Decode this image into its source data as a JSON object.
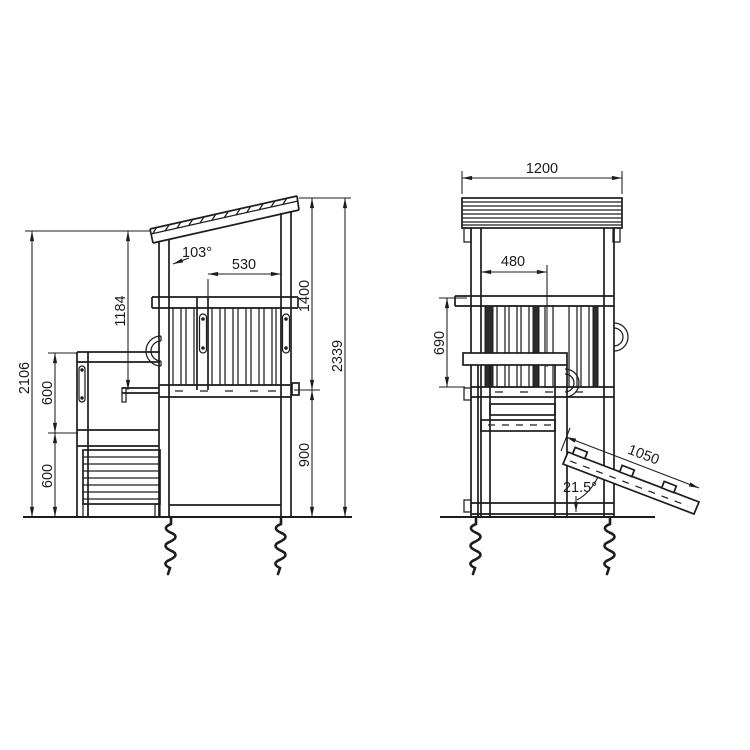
{
  "drawing": {
    "background": "#ffffff",
    "line_color": "#1d1d1d",
    "side_view": {
      "labels": {
        "overall_height_left": "2106",
        "annex_upper_height": "600",
        "annex_lower_height": "600",
        "roof_to_deck": "1184",
        "roof_angle": "103°",
        "deck_opening_width": "530",
        "roof_to_deck_right": "1400",
        "overall_height": "2339",
        "deck_height": "900"
      }
    },
    "front_view": {
      "labels": {
        "roof_width": "1200",
        "entry_offset": "480",
        "railing_height": "690",
        "ramp_length": "1050",
        "ramp_angle": "21.5°"
      }
    }
  }
}
